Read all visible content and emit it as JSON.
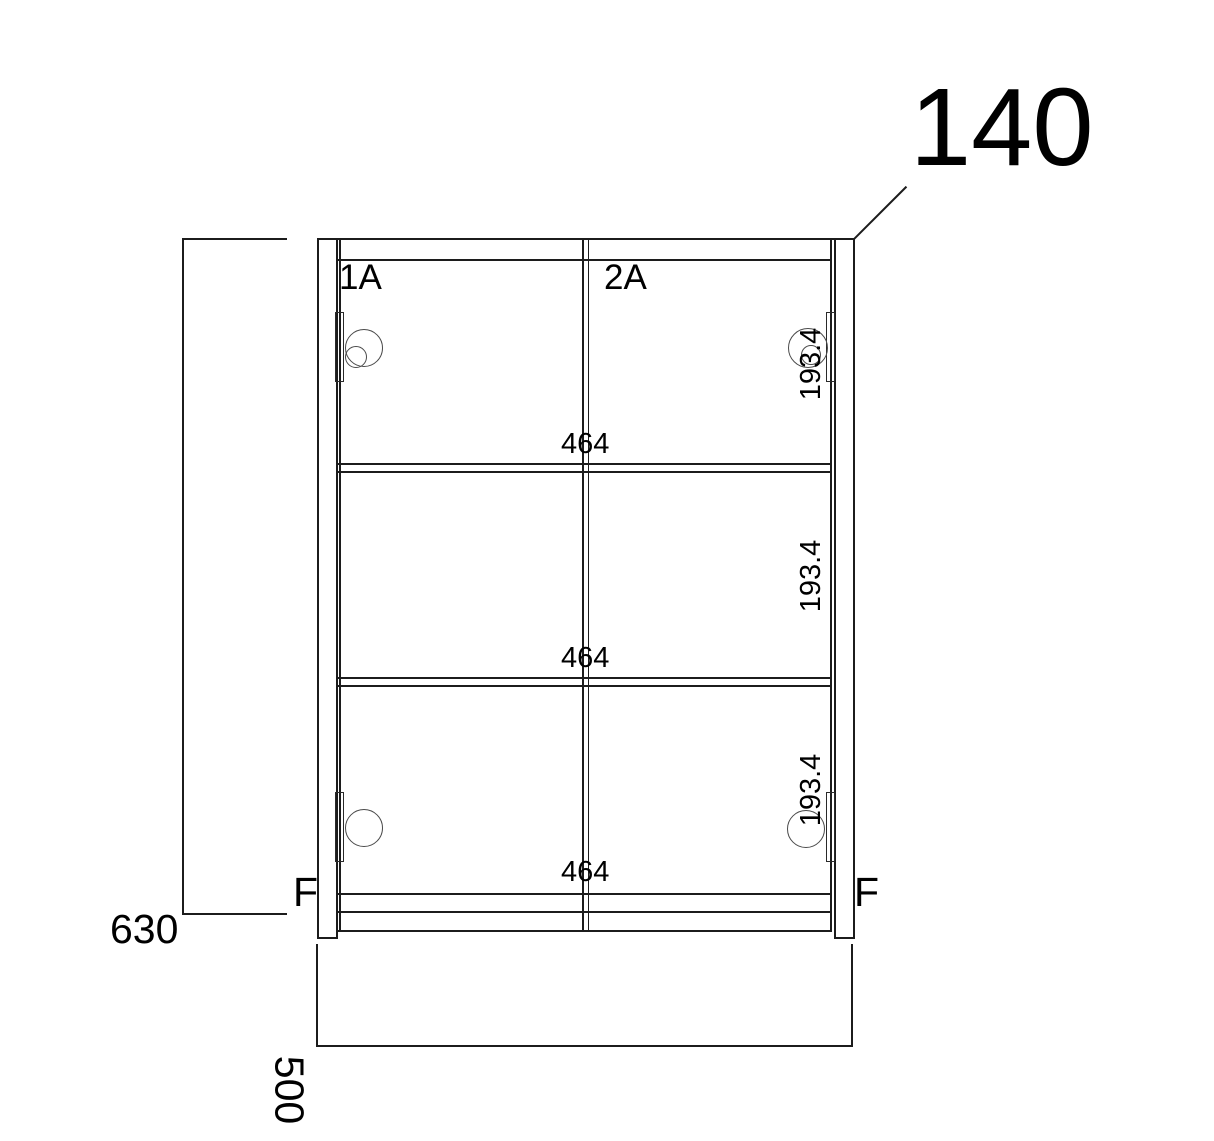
{
  "drawing": {
    "top_thickness_dim": "140",
    "doors": [
      {
        "label": "1A"
      },
      {
        "label": "2A"
      }
    ],
    "inner_width_dims": [
      "464",
      "464",
      "464"
    ],
    "section_height_dims": [
      "193.4",
      "193.4",
      "193.4"
    ],
    "hinge_side_labels": [
      "F",
      "F"
    ],
    "overall_height_dim": "630",
    "depth_dim": "500",
    "colors": {
      "line": "#1c1c1c",
      "text": "#000000",
      "background": "#ffffff"
    }
  }
}
